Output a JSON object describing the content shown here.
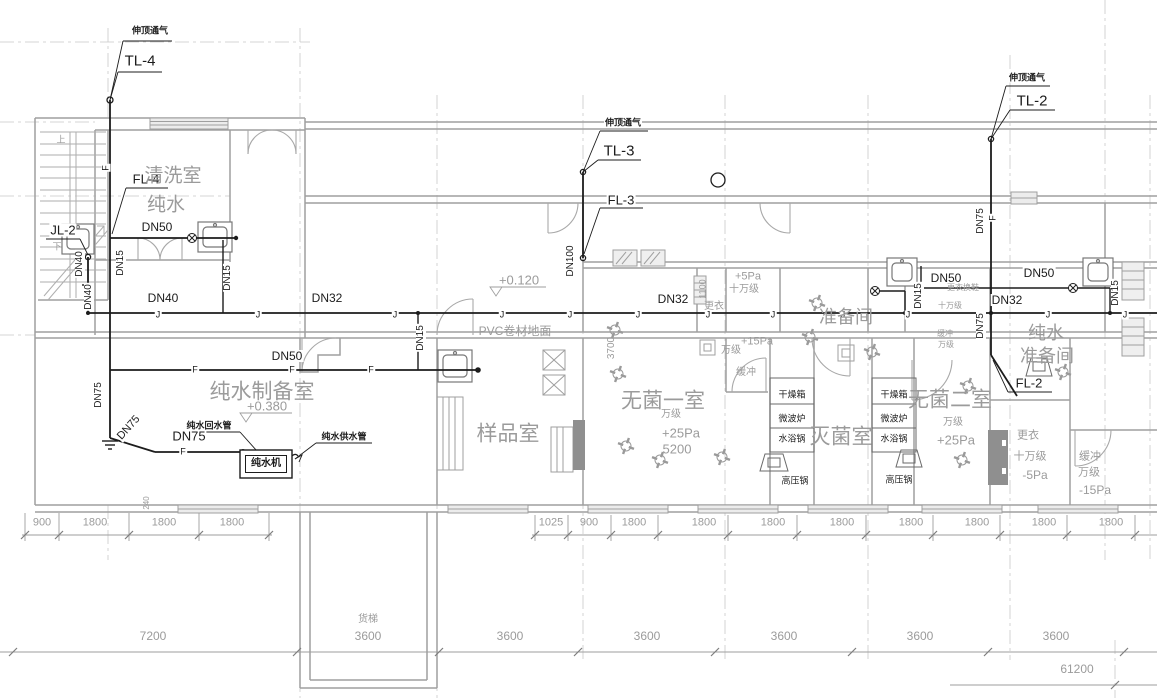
{
  "drawing": {
    "type": "plumbing-floor-plan",
    "colors": {
      "background": "#ffffff",
      "pipe": "#1c1c1c",
      "wall": "#9f9f9f",
      "annotation": "#9b9b9b"
    },
    "labels": {
      "riser_labels": [
        {
          "t": "伸顶通气",
          "x": 150,
          "y": 31,
          "fs": 9,
          "b": 1,
          "n": "vent-note-tl4"
        },
        {
          "t": "TL-4",
          "x": 140,
          "y": 61,
          "fs": 15,
          "n": "riser-tl4"
        },
        {
          "t": "FL-4",
          "x": 146,
          "y": 179,
          "fs": 13,
          "n": "riser-fl4"
        },
        {
          "t": "JL-2",
          "x": 63,
          "y": 230,
          "fs": 13,
          "n": "riser-jl2"
        },
        {
          "t": "伸顶通气",
          "x": 623,
          "y": 123,
          "fs": 9,
          "b": 1,
          "n": "vent-note-tl3"
        },
        {
          "t": "TL-3",
          "x": 619,
          "y": 151,
          "fs": 15,
          "n": "riser-tl3"
        },
        {
          "t": "FL-3",
          "x": 621,
          "y": 200,
          "fs": 13,
          "n": "riser-fl3"
        },
        {
          "t": "伸顶通气",
          "x": 1027,
          "y": 78,
          "fs": 9,
          "b": 1,
          "n": "vent-note-tl2"
        },
        {
          "t": "TL-2",
          "x": 1032,
          "y": 101,
          "fs": 15,
          "n": "riser-tl2"
        },
        {
          "t": "FL-2",
          "x": 1029,
          "y": 383,
          "fs": 13,
          "n": "riser-fl2"
        }
      ],
      "pipe_size_labels": [
        {
          "t": "DN50",
          "x": 157,
          "y": 227,
          "fs": 12
        },
        {
          "t": "DN15",
          "x": 121,
          "y": 263,
          "fs": 10,
          "r": -90
        },
        {
          "t": "DN40",
          "x": 80,
          "y": 264,
          "fs": 10,
          "r": -90
        },
        {
          "t": "DN40",
          "x": 89,
          "y": 297,
          "fs": 10,
          "r": -90
        },
        {
          "t": "DN15",
          "x": 228,
          "y": 278,
          "fs": 10,
          "r": -90
        },
        {
          "t": "DN40",
          "x": 163,
          "y": 298,
          "fs": 12
        },
        {
          "t": "DN32",
          "x": 327,
          "y": 298,
          "fs": 12
        },
        {
          "t": "DN50",
          "x": 287,
          "y": 356,
          "fs": 12
        },
        {
          "t": "DN15",
          "x": 421,
          "y": 338,
          "fs": 10,
          "r": -90
        },
        {
          "t": "DN75",
          "x": 99,
          "y": 395,
          "fs": 10,
          "r": -90
        },
        {
          "t": "DN75",
          "x": 129,
          "y": 428,
          "fs": 11,
          "r": -48
        },
        {
          "t": "DN75",
          "x": 189,
          "y": 436,
          "fs": 13
        },
        {
          "t": "DN100",
          "x": 571,
          "y": 261,
          "fs": 10,
          "r": -90
        },
        {
          "t": "DN32",
          "x": 673,
          "y": 299,
          "fs": 12
        },
        {
          "t": "DN75",
          "x": 981,
          "y": 221,
          "fs": 10,
          "r": -90
        },
        {
          "t": "DN15",
          "x": 919,
          "y": 296,
          "fs": 10,
          "r": -90
        },
        {
          "t": "DN50",
          "x": 946,
          "y": 278,
          "fs": 12
        },
        {
          "t": "DN75",
          "x": 981,
          "y": 326,
          "fs": 10,
          "r": -90
        },
        {
          "t": "DN32",
          "x": 1007,
          "y": 300,
          "fs": 12
        },
        {
          "t": "DN50",
          "x": 1039,
          "y": 273,
          "fs": 12
        },
        {
          "t": "DN15",
          "x": 1116,
          "y": 293,
          "fs": 10,
          "r": -90
        }
      ],
      "pipe_letters": [
        {
          "t": "J",
          "x": 158,
          "y": 315
        },
        {
          "t": "J",
          "x": 258,
          "y": 315
        },
        {
          "t": "J",
          "x": 395,
          "y": 315
        },
        {
          "t": "J",
          "x": 502,
          "y": 315
        },
        {
          "t": "J",
          "x": 570,
          "y": 315
        },
        {
          "t": "J",
          "x": 638,
          "y": 315
        },
        {
          "t": "J",
          "x": 708,
          "y": 315
        },
        {
          "t": "J",
          "x": 773,
          "y": 315
        },
        {
          "t": "J",
          "x": 843,
          "y": 315
        },
        {
          "t": "J",
          "x": 908,
          "y": 315
        },
        {
          "t": "J",
          "x": 1048,
          "y": 315
        },
        {
          "t": "J",
          "x": 1125,
          "y": 315
        },
        {
          "t": "F",
          "x": 195,
          "y": 370
        },
        {
          "t": "F",
          "x": 292,
          "y": 370
        },
        {
          "t": "F",
          "x": 371,
          "y": 370
        },
        {
          "t": "F",
          "x": 183,
          "y": 452
        },
        {
          "t": "F",
          "x": 106,
          "y": 168,
          "r": -90
        },
        {
          "t": "F",
          "x": 993,
          "y": 218,
          "r": -90
        }
      ],
      "pipe_notes": [
        {
          "t": "纯水回水管",
          "x": 209,
          "y": 426,
          "fs": 9,
          "b": 1,
          "n": "note-pure-water-return-pipe"
        },
        {
          "t": "纯水供水管",
          "x": 344,
          "y": 437,
          "fs": 9,
          "b": 1,
          "n": "note-pure-water-supply-pipe"
        }
      ],
      "room_labels": [
        {
          "t": "清洗室",
          "x": 173,
          "y": 176,
          "fs": 19,
          "n": "room-washing"
        },
        {
          "t": "纯水",
          "x": 166,
          "y": 205,
          "fs": 19,
          "n": "room-washing-2"
        },
        {
          "t": "纯水制备室",
          "x": 262,
          "y": 392,
          "fs": 21,
          "n": "room-pure-water-prep"
        },
        {
          "t": "样品室",
          "x": 508,
          "y": 434,
          "fs": 21,
          "n": "room-sample"
        },
        {
          "t": "无菌一室",
          "x": 663,
          "y": 401,
          "fs": 21,
          "n": "room-sterile-1"
        },
        {
          "t": "灭菌室",
          "x": 841,
          "y": 437,
          "fs": 21,
          "n": "room-sterilization"
        },
        {
          "t": "无菌二室",
          "x": 950,
          "y": 400,
          "fs": 21,
          "n": "room-sterile-2"
        },
        {
          "t": "准备间",
          "x": 846,
          "y": 317,
          "fs": 18,
          "n": "room-prep"
        },
        {
          "t": "纯水",
          "x": 1046,
          "y": 333,
          "fs": 18,
          "n": "room-pure-water-prep2-line1"
        },
        {
          "t": "准备间",
          "x": 1047,
          "y": 356,
          "fs": 18,
          "n": "room-pure-water-prep2-line2"
        },
        {
          "t": "货梯",
          "x": 368,
          "y": 620,
          "fs": 10,
          "n": "freight-elevator"
        }
      ],
      "pressure_labels": [
        {
          "t": "+5Pa",
          "x": 748,
          "y": 277,
          "fs": 11
        },
        {
          "t": "十万级",
          "x": 744,
          "y": 290,
          "fs": 10
        },
        {
          "t": "更衣",
          "x": 714,
          "y": 307,
          "fs": 10
        },
        {
          "t": "+15Pa",
          "x": 757,
          "y": 342,
          "fs": 11
        },
        {
          "t": "万级",
          "x": 731,
          "y": 351,
          "fs": 10
        },
        {
          "t": "缓冲",
          "x": 746,
          "y": 373,
          "fs": 10
        },
        {
          "t": "万级",
          "x": 671,
          "y": 415,
          "fs": 10
        },
        {
          "t": "+25Pa",
          "x": 681,
          "y": 433,
          "fs": 13
        },
        {
          "t": "5200",
          "x": 677,
          "y": 449,
          "fs": 13
        },
        {
          "t": "更衣换鞋",
          "x": 963,
          "y": 288,
          "fs": 8
        },
        {
          "t": "十万级",
          "x": 950,
          "y": 306,
          "fs": 8
        },
        {
          "t": "缓冲",
          "x": 945,
          "y": 334,
          "fs": 8
        },
        {
          "t": "万级",
          "x": 946,
          "y": 345,
          "fs": 8
        },
        {
          "t": "万级",
          "x": 953,
          "y": 423,
          "fs": 10
        },
        {
          "t": "+25Pa",
          "x": 956,
          "y": 440,
          "fs": 13
        },
        {
          "t": "更衣",
          "x": 1028,
          "y": 436,
          "fs": 11
        },
        {
          "t": "十万级",
          "x": 1030,
          "y": 457,
          "fs": 11
        },
        {
          "t": "-5Pa",
          "x": 1035,
          "y": 475,
          "fs": 12
        },
        {
          "t": "缓冲",
          "x": 1090,
          "y": 457,
          "fs": 11
        },
        {
          "t": "万级",
          "x": 1089,
          "y": 473,
          "fs": 11
        },
        {
          "t": "-15Pa",
          "x": 1095,
          "y": 490,
          "fs": 12
        }
      ],
      "elevation_labels": [
        {
          "t": "+0.380",
          "x": 267,
          "y": 406,
          "fs": 13,
          "n": "elevation-0380"
        },
        {
          "t": "+0.120",
          "x": 519,
          "y": 280,
          "fs": 13,
          "n": "elevation-0120"
        }
      ],
      "floor_labels": [
        {
          "t": "PVC卷材地面",
          "x": 515,
          "y": 331,
          "fs": 12,
          "n": "floor-finish-pvc"
        }
      ],
      "equipment_labels": [
        {
          "t": "干燥箱",
          "x": 792,
          "y": 395,
          "fs": 9
        },
        {
          "t": "微波炉",
          "x": 792,
          "y": 419,
          "fs": 9
        },
        {
          "t": "水浴锅",
          "x": 792,
          "y": 439,
          "fs": 9
        },
        {
          "t": "高压锅",
          "x": 795,
          "y": 481,
          "fs": 9
        },
        {
          "t": "干燥箱",
          "x": 894,
          "y": 395,
          "fs": 9
        },
        {
          "t": "微波炉",
          "x": 894,
          "y": 419,
          "fs": 9
        },
        {
          "t": "水浴锅",
          "x": 894,
          "y": 439,
          "fs": 9
        },
        {
          "t": "高压锅",
          "x": 899,
          "y": 480,
          "fs": 9
        },
        {
          "t": "纯水机",
          "x": 266,
          "y": 464,
          "fs": 10,
          "b": 1,
          "box": 1,
          "n": "pure-water-machine"
        }
      ],
      "stair_labels": [
        {
          "t": "上",
          "x": 61,
          "y": 140,
          "fs": 9,
          "n": "stair-up"
        },
        {
          "t": "下",
          "x": 57,
          "y": 247,
          "fs": 9,
          "n": "stair-down"
        }
      ],
      "dimension_labels": [
        {
          "t": "900",
          "x": 42,
          "y": 523,
          "fs": 11
        },
        {
          "t": "1800",
          "x": 95,
          "y": 523,
          "fs": 11
        },
        {
          "t": "1800",
          "x": 164,
          "y": 523,
          "fs": 11
        },
        {
          "t": "1800",
          "x": 232,
          "y": 523,
          "fs": 11
        },
        {
          "t": "1025",
          "x": 551,
          "y": 523,
          "fs": 11
        },
        {
          "t": "900",
          "x": 589,
          "y": 523,
          "fs": 11
        },
        {
          "t": "1800",
          "x": 634,
          "y": 523,
          "fs": 11
        },
        {
          "t": "1800",
          "x": 704,
          "y": 523,
          "fs": 11
        },
        {
          "t": "1800",
          "x": 773,
          "y": 523,
          "fs": 11
        },
        {
          "t": "1800",
          "x": 842,
          "y": 523,
          "fs": 11
        },
        {
          "t": "1800",
          "x": 911,
          "y": 523,
          "fs": 11
        },
        {
          "t": "1800",
          "x": 977,
          "y": 523,
          "fs": 11
        },
        {
          "t": "1800",
          "x": 1044,
          "y": 523,
          "fs": 11
        },
        {
          "t": "1800",
          "x": 1111,
          "y": 523,
          "fs": 11
        },
        {
          "t": "7200",
          "x": 153,
          "y": 636,
          "fs": 12
        },
        {
          "t": "3600",
          "x": 368,
          "y": 636,
          "fs": 12
        },
        {
          "t": "3600",
          "x": 510,
          "y": 636,
          "fs": 12
        },
        {
          "t": "3600",
          "x": 647,
          "y": 636,
          "fs": 12
        },
        {
          "t": "3600",
          "x": 784,
          "y": 636,
          "fs": 12
        },
        {
          "t": "3600",
          "x": 920,
          "y": 636,
          "fs": 12
        },
        {
          "t": "3600",
          "x": 1056,
          "y": 636,
          "fs": 12
        },
        {
          "t": "61200",
          "x": 1077,
          "y": 669,
          "fs": 12
        },
        {
          "t": "240",
          "x": 147,
          "y": 503,
          "fs": 8,
          "r": -90
        },
        {
          "t": "3700",
          "x": 612,
          "y": 348,
          "fs": 10,
          "r": -90
        },
        {
          "t": "1100",
          "x": 703,
          "y": 289,
          "fs": 9,
          "r": -90
        }
      ]
    }
  }
}
